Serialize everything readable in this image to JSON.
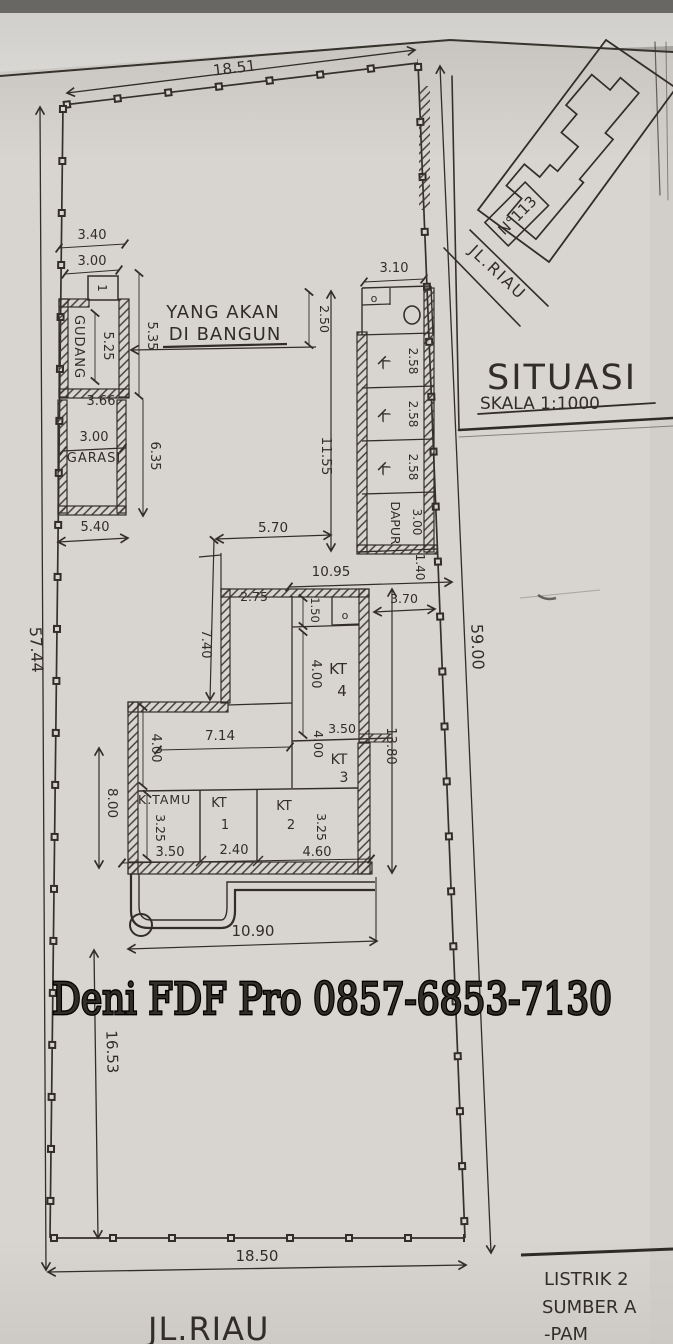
{
  "watermark": "Deni FDF Pro 0857-6853-7130",
  "situasi": {
    "title": "SITUASI",
    "scale": "SKALA 1:1000",
    "house_no": "N°113",
    "road": "JL.RIAU"
  },
  "streets": {
    "bottom": "JL.RIAU"
  },
  "annotation": {
    "line1": "YANG AKAN",
    "line2": "DI BANGUN"
  },
  "notes": {
    "line1": "LISTRIK 2",
    "line2": "SUMBER A",
    "line3": "-PAM"
  },
  "rooms": {
    "gudang": "GUDANG",
    "garasi": "GARASI",
    "dapur": "DAPUR",
    "k": "K",
    "toilet": "o",
    "box1": "1",
    "kt": "KT",
    "n1": "1",
    "n2": "2",
    "n3": "3",
    "n4": "4",
    "ktamu": "K.TAMU"
  },
  "dims": {
    "plot_top": "18.51",
    "plot_bottom": "18.50",
    "plot_left": "57.44",
    "plot_right": "59.00",
    "front_yard": "16.53",
    "porch_width": "10.90",
    "gudang_top": "3.40",
    "gudang_width": "3.00",
    "gudang_len": "5.25",
    "gudang_side": "5.35",
    "gudang_bottom": "3.66",
    "garasi_width": "3.00",
    "garasi_side": "6.35",
    "garasi_bottom": "5.40",
    "service_top": "3.10",
    "service_o": "2.50",
    "k_a": "2.58",
    "k_b": "2.58",
    "k_c": "2.58",
    "dapur_len": "3.00",
    "service_gap": "1.40",
    "service_len": "11.55",
    "mid_offset": "5.70",
    "mid_len": "10.95",
    "kt4_top": "2.75",
    "bath": "1.50",
    "side_gap": "3.70",
    "wing_len": "13.80",
    "corridor": "7.40",
    "kt4_len": "4.00",
    "kt3_top": "3.50",
    "kt3_len": "4.00",
    "hall_top": "7.14",
    "hall_left": "4.00",
    "hall_side": "8.00",
    "ktamu_len": "3.25",
    "kt2_len": "3.25",
    "ktamu_w": "3.50",
    "kt1_w": "2.40",
    "kt2_w": "4.60"
  }
}
